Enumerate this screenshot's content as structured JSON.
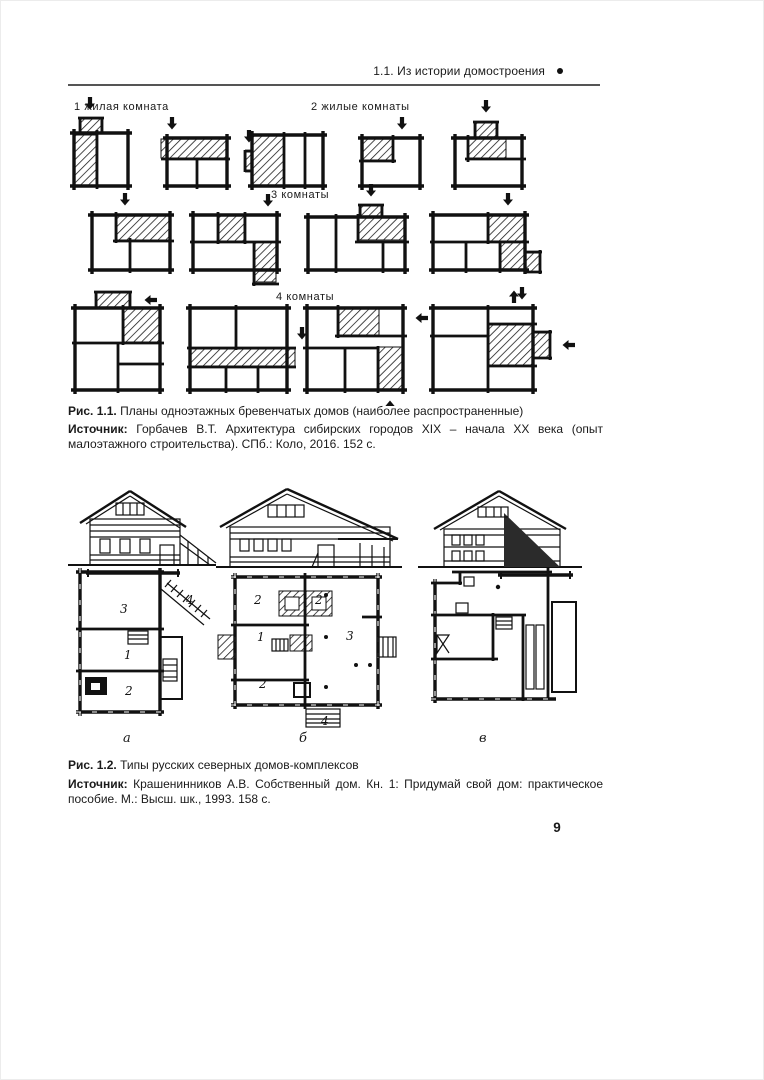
{
  "colors": {
    "ink": "#1a1a1a",
    "paper": "#ffffff"
  },
  "header": {
    "title": "1.1. Из истории домостроения"
  },
  "fig1": {
    "row_labels": [
      "1 жилая комната",
      "2 жилые комнаты",
      "3 комнаты",
      "4 комнаты"
    ],
    "caption_label": "Рис. 1.1.",
    "caption_text": "Планы одноэтажных бревенчатых домов (наиболее распространенные)",
    "source_label": "Источник:",
    "source_text": "Горбачев В.Т. Архитектура сибирских городов XIX – начала XX века (опыт малоэтажного строительства). СПб.: Коло, 2016. 152 с."
  },
  "fig2": {
    "panel_labels": [
      "а",
      "б",
      "в"
    ],
    "plan_a_rooms": [
      "3",
      "4",
      "1",
      "2"
    ],
    "plan_b_rooms": [
      "2",
      "2",
      "1",
      "3",
      "2",
      "4"
    ],
    "caption_label": "Рис. 1.2.",
    "caption_text": "Типы русских северных домов-комплексов",
    "source_label": "Источник:",
    "source_text": "Крашенинников А.В. Собственный дом. Кн. 1: Придумай свой дом: практическое пособие. М.: Высш. шк., 1993. 158 с."
  },
  "page_number": "9"
}
